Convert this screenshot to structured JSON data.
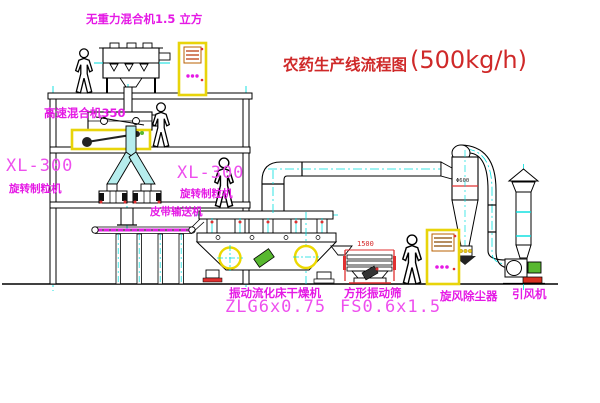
{
  "title": {
    "text": "农药生产线流程图",
    "capacity": "(500kg/h)"
  },
  "equipment_labels": {
    "gravity_free_mixer": "无重力混合机1.5 立方",
    "high_speed_mixer": "高速混合机350",
    "granulator_left_model": "XL-300",
    "granulator_left_name": "旋转制粒机",
    "granulator_right_model": "XL-300",
    "granulator_right_name": "旋转制粒机",
    "belt_conveyor": "皮带输送机",
    "fluid_bed_dryer_name": "振动流化床干燥机",
    "fluid_bed_dryer_model": "ZLG6x0.75",
    "square_sieve_name": "方形振动筛",
    "square_sieve_model": "FS0.6x1.5",
    "cyclone_dust_collector": "旋风除尘器",
    "induced_draft_fan": "引风机"
  },
  "dimensions": {
    "sieve_width": "1500",
    "cyclone_note": "Φ600"
  },
  "colors": {
    "label_magenta": "#e519e5",
    "title_red": "#cf2929",
    "centerline_cyan": "#00dede",
    "cabinet_yellow": "#e8d40a",
    "machine_green": "#58b830",
    "detail_red": "#e03030",
    "line_black": "#000000"
  }
}
